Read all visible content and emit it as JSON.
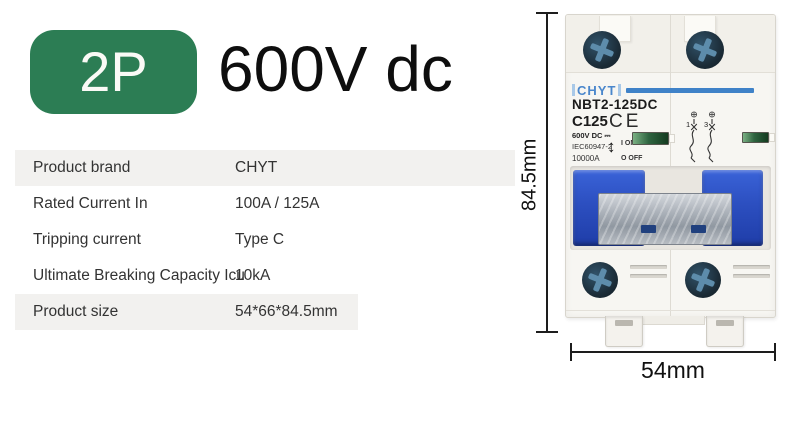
{
  "header": {
    "pole_badge": "2P",
    "voltage_title": "600V dc"
  },
  "colors": {
    "badge_green": "#2c7d54",
    "brand_blue": "#4a87cc",
    "logo_line_blue": "#3f82c8",
    "handle_blue": "#2c4fc0",
    "indicator_green": "#2e6440"
  },
  "spec_table": {
    "rows": [
      {
        "label": "Product brand",
        "value": "CHYT"
      },
      {
        "label": "Rated Current In",
        "value": "100A / 125A"
      },
      {
        "label": "Tripping current",
        "value": "Type C"
      },
      {
        "label": "Ultimate Breaking Capacity Icu",
        "value": "10kA"
      },
      {
        "label": "Product size",
        "value": "54*66*84.5mm"
      }
    ]
  },
  "breaker": {
    "brand": "CHYT",
    "model": "NBT2-125DC",
    "rating": "C125",
    "ce_mark": "CE",
    "voltage_line": "600V DC ⎓",
    "standard": "IEC60947-2",
    "breaking_capacity": "10000A",
    "arrow_glyph": "↕",
    "on_label": "I ON",
    "off_label": "O OFF",
    "terminals": {
      "top_left": "1",
      "top_right": "3",
      "bottom_left": "2",
      "bottom_right": "4"
    }
  },
  "dimensions": {
    "height_label": "84.5mm",
    "width_label": "54mm"
  }
}
